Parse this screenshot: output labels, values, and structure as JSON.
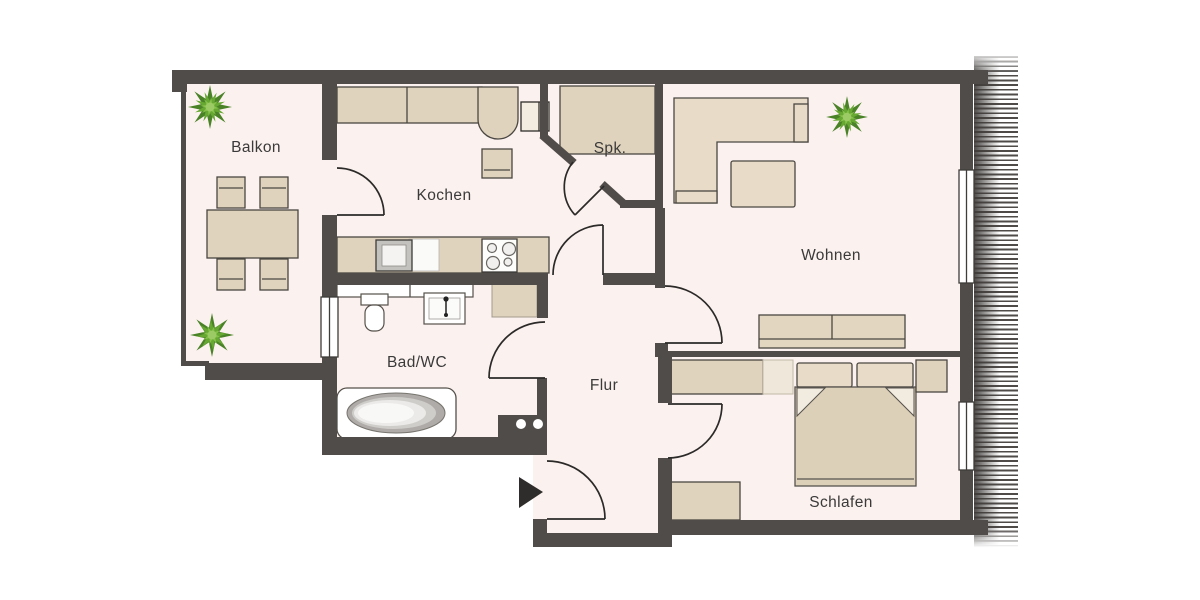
{
  "floorplan": {
    "rooms": {
      "balkon": {
        "label": "Balkon"
      },
      "kochen": {
        "label": "Kochen"
      },
      "spk": {
        "label": "Spk."
      },
      "wohnen": {
        "label": "Wohnen"
      },
      "bad_wc": {
        "label": "Bad/WC"
      },
      "flur": {
        "label": "Flur"
      },
      "schlafen": {
        "label": "Schlafen"
      }
    },
    "colors": {
      "wall": "#4f4c4a",
      "floor": "#fbf1ee",
      "furniture": "#e0d3bd",
      "furniture_light": "#efe7da",
      "outline": "#4a4742",
      "plant_dark": "#4a8227",
      "plant_mid": "#66a832",
      "plant_light": "#86c24a"
    }
  }
}
